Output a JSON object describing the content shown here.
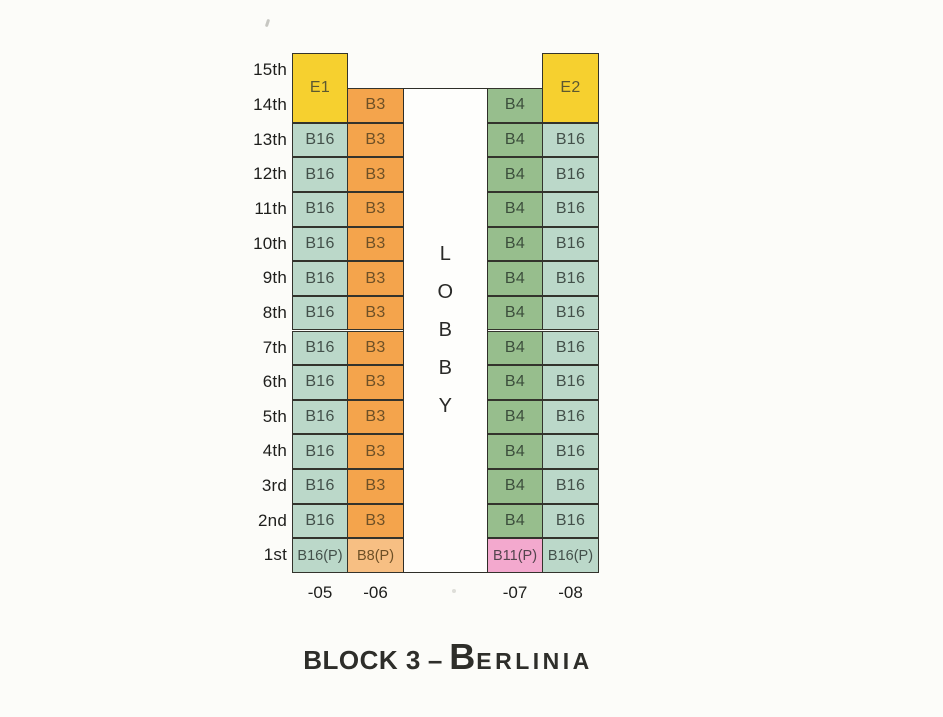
{
  "palette": {
    "yellow": "#F6D02F",
    "orange": "#F4A44C",
    "peach": "#F7BF83",
    "teal": "#BBD8C9",
    "green": "#97BE8D",
    "pink": "#F3A9CE"
  },
  "cell_text": {
    "yellow": "#5c5830",
    "orange": "#6e5026",
    "peach": "#6e5026",
    "teal": "#43504a",
    "green": "#3c4e3c",
    "pink": "#54444e"
  },
  "floors": [
    "15th",
    "14th",
    "13th",
    "12th",
    "11th",
    "10th",
    "9th",
    "8th",
    "7th",
    "6th",
    "5th",
    "4th",
    "3rd",
    "2nd",
    "1st"
  ],
  "lobby": {
    "label": "LOBBY",
    "letters": [
      "L",
      "O",
      "B",
      "B",
      "Y"
    ]
  },
  "columns": [
    {
      "id": "c05",
      "stack_label": "-05",
      "cells": [
        {
          "unit": "E1",
          "row": 0,
          "span": 2,
          "color": "yellow"
        },
        {
          "unit": "B16",
          "row": 2,
          "span": 1,
          "color": "teal"
        },
        {
          "unit": "B16",
          "row": 3,
          "span": 1,
          "color": "teal"
        },
        {
          "unit": "B16",
          "row": 4,
          "span": 1,
          "color": "teal"
        },
        {
          "unit": "B16",
          "row": 5,
          "span": 1,
          "color": "teal"
        },
        {
          "unit": "B16",
          "row": 6,
          "span": 1,
          "color": "teal"
        },
        {
          "unit": "B16",
          "row": 7,
          "span": 1,
          "color": "teal"
        },
        {
          "unit": "B16",
          "row": 8,
          "span": 1,
          "color": "teal"
        },
        {
          "unit": "B16",
          "row": 9,
          "span": 1,
          "color": "teal"
        },
        {
          "unit": "B16",
          "row": 10,
          "span": 1,
          "color": "teal"
        },
        {
          "unit": "B16",
          "row": 11,
          "span": 1,
          "color": "teal"
        },
        {
          "unit": "B16",
          "row": 12,
          "span": 1,
          "color": "teal"
        },
        {
          "unit": "B16",
          "row": 13,
          "span": 1,
          "color": "teal"
        },
        {
          "unit": "B16(P)",
          "row": 14,
          "span": 1,
          "color": "teal"
        }
      ]
    },
    {
      "id": "c06",
      "stack_label": "-06",
      "cells": [
        {
          "unit": "B3",
          "row": 1,
          "span": 1,
          "color": "orange"
        },
        {
          "unit": "B3",
          "row": 2,
          "span": 1,
          "color": "orange"
        },
        {
          "unit": "B3",
          "row": 3,
          "span": 1,
          "color": "orange"
        },
        {
          "unit": "B3",
          "row": 4,
          "span": 1,
          "color": "orange"
        },
        {
          "unit": "B3",
          "row": 5,
          "span": 1,
          "color": "orange"
        },
        {
          "unit": "B3",
          "row": 6,
          "span": 1,
          "color": "orange"
        },
        {
          "unit": "B3",
          "row": 7,
          "span": 1,
          "color": "orange"
        },
        {
          "unit": "B3",
          "row": 8,
          "span": 1,
          "color": "orange"
        },
        {
          "unit": "B3",
          "row": 9,
          "span": 1,
          "color": "orange"
        },
        {
          "unit": "B3",
          "row": 10,
          "span": 1,
          "color": "orange"
        },
        {
          "unit": "B3",
          "row": 11,
          "span": 1,
          "color": "orange"
        },
        {
          "unit": "B3",
          "row": 12,
          "span": 1,
          "color": "orange"
        },
        {
          "unit": "B3",
          "row": 13,
          "span": 1,
          "color": "orange"
        },
        {
          "unit": "B8(P)",
          "row": 14,
          "span": 1,
          "color": "peach"
        }
      ]
    },
    {
      "id": "c07",
      "stack_label": "-07",
      "cells": [
        {
          "unit": "B4",
          "row": 1,
          "span": 1,
          "color": "green"
        },
        {
          "unit": "B4",
          "row": 2,
          "span": 1,
          "color": "green"
        },
        {
          "unit": "B4",
          "row": 3,
          "span": 1,
          "color": "green"
        },
        {
          "unit": "B4",
          "row": 4,
          "span": 1,
          "color": "green"
        },
        {
          "unit": "B4",
          "row": 5,
          "span": 1,
          "color": "green"
        },
        {
          "unit": "B4",
          "row": 6,
          "span": 1,
          "color": "green"
        },
        {
          "unit": "B4",
          "row": 7,
          "span": 1,
          "color": "green"
        },
        {
          "unit": "B4",
          "row": 8,
          "span": 1,
          "color": "green"
        },
        {
          "unit": "B4",
          "row": 9,
          "span": 1,
          "color": "green"
        },
        {
          "unit": "B4",
          "row": 10,
          "span": 1,
          "color": "green"
        },
        {
          "unit": "B4",
          "row": 11,
          "span": 1,
          "color": "green"
        },
        {
          "unit": "B4",
          "row": 12,
          "span": 1,
          "color": "green"
        },
        {
          "unit": "B4",
          "row": 13,
          "span": 1,
          "color": "green"
        },
        {
          "unit": "B11(P)",
          "row": 14,
          "span": 1,
          "color": "pink"
        }
      ]
    },
    {
      "id": "c08",
      "stack_label": "-08",
      "cells": [
        {
          "unit": "E2",
          "row": 0,
          "span": 2,
          "color": "yellow"
        },
        {
          "unit": "B16",
          "row": 2,
          "span": 1,
          "color": "teal"
        },
        {
          "unit": "B16",
          "row": 3,
          "span": 1,
          "color": "teal"
        },
        {
          "unit": "B16",
          "row": 4,
          "span": 1,
          "color": "teal"
        },
        {
          "unit": "B16",
          "row": 5,
          "span": 1,
          "color": "teal"
        },
        {
          "unit": "B16",
          "row": 6,
          "span": 1,
          "color": "teal"
        },
        {
          "unit": "B16",
          "row": 7,
          "span": 1,
          "color": "teal"
        },
        {
          "unit": "B16",
          "row": 8,
          "span": 1,
          "color": "teal"
        },
        {
          "unit": "B16",
          "row": 9,
          "span": 1,
          "color": "teal"
        },
        {
          "unit": "B16",
          "row": 10,
          "span": 1,
          "color": "teal"
        },
        {
          "unit": "B16",
          "row": 11,
          "span": 1,
          "color": "teal"
        },
        {
          "unit": "B16",
          "row": 12,
          "span": 1,
          "color": "teal"
        },
        {
          "unit": "B16",
          "row": 13,
          "span": 1,
          "color": "teal"
        },
        {
          "unit": "B16(P)",
          "row": 14,
          "span": 1,
          "color": "teal"
        }
      ]
    }
  ],
  "title": {
    "block": "BLOCK 3",
    "separator": "–",
    "name_initial": "B",
    "name_rest": "ERLINIA"
  }
}
